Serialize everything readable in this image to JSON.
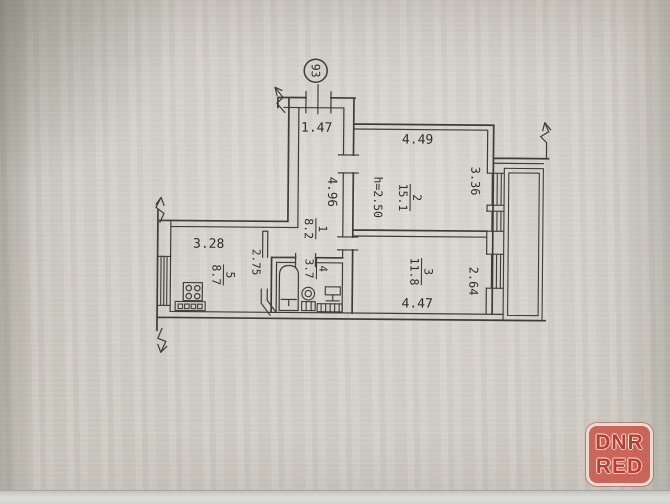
{
  "plan": {
    "apartment_number": "93",
    "height_note": "h=2.50",
    "rooms": [
      {
        "number": "1",
        "area": "8.2"
      },
      {
        "number": "2",
        "area": "15.1"
      },
      {
        "number": "3",
        "area": "11.8"
      },
      {
        "number": "4",
        "area": "3.7"
      },
      {
        "number": "5",
        "area": "8.7"
      }
    ],
    "dimensions": {
      "entry_width": "1.47",
      "corridor_length": "4.96",
      "room2_width": "4.49",
      "room2_depth": "3.36",
      "room3_width": "4.47",
      "room3_depth": "2.64",
      "kitchen_width": "3.28",
      "lobby_width": "2.75"
    },
    "colors": {
      "line": "#3f3c35",
      "paper": "#cfccc4",
      "watermark_red": "#c03a2e"
    }
  },
  "watermark": {
    "line1": "DNR",
    "line2": "RED"
  }
}
